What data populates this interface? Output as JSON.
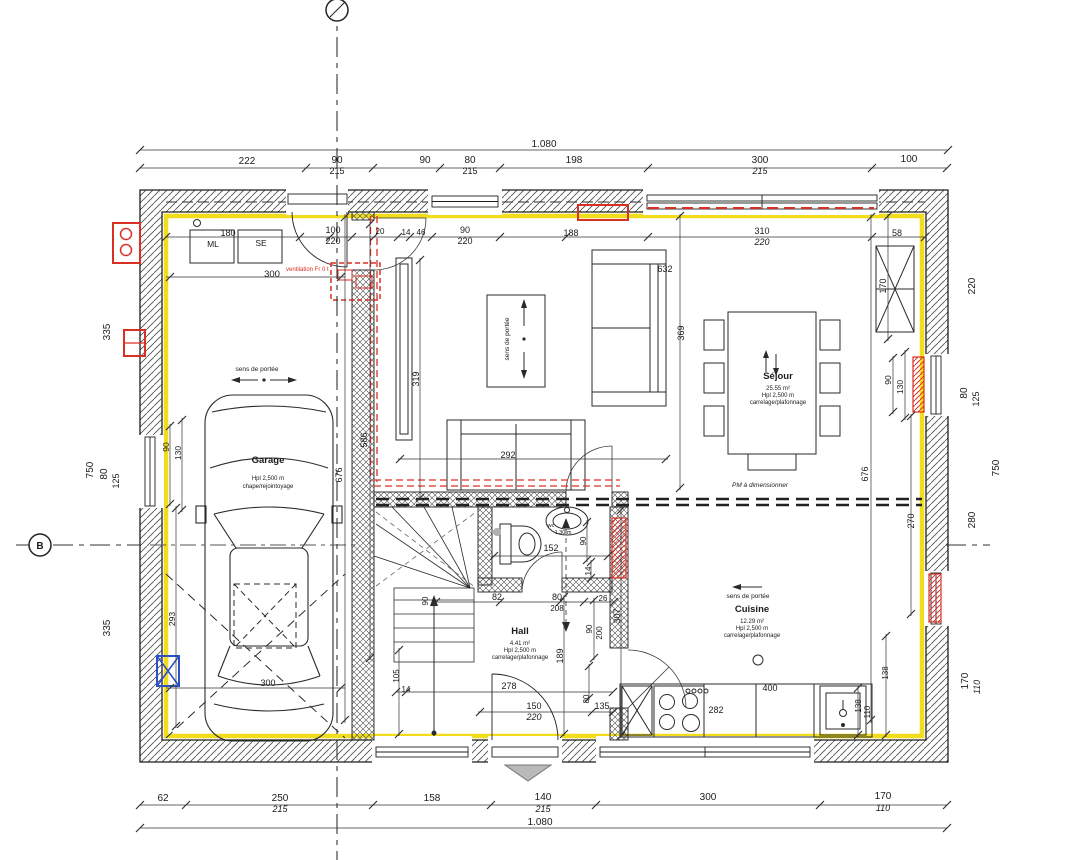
{
  "colors": {
    "paper": "#ffffff",
    "ink": "#1e1e1e",
    "insulation_yellow": "#f1dd1b",
    "annotation_red": "#d93025",
    "marker_blue": "#2b50c8",
    "step_gray": "#b9b9b9"
  },
  "rooms": [
    {
      "name": "Garage",
      "ceiling": "Hpl 2,500 m",
      "finish": "chape/rejointoyage"
    },
    {
      "name": "Séjour",
      "area": "25.55 m²",
      "ceiling": "Hpl 2,500 m",
      "finish": "carrelage/plafonnage"
    },
    {
      "name": "Cuisine",
      "area": "12.29 m²",
      "ceiling": "Hpl 2,500 m",
      "finish": "carrelage/plafonnage"
    },
    {
      "name": "Hall",
      "area": "4.41 m²",
      "ceiling": "Hpl 2,500 m",
      "finish": "carrelage/plafonnage"
    },
    {
      "name": "wc",
      "area": "1.30 m"
    }
  ],
  "annotations": {
    "span_direction": "sens de portée",
    "beam_note": "PM à dimensionner",
    "vent_note": "ventilation Fr 0 t",
    "washer": "ML",
    "dryer": "SE",
    "section_marker": "B"
  },
  "dims": {
    "top": {
      "total": "1.080",
      "d1": "222",
      "d2": "90",
      "d2s": "215",
      "d3": "90",
      "d4": "80",
      "d4s": "215",
      "d5": "198",
      "d6": "300",
      "d6s": "215",
      "d7": "100"
    },
    "bottom": {
      "total": "1.080",
      "d1": "62",
      "d2": "250",
      "d2s": "215",
      "d3": "158",
      "d4": "140",
      "d4s": "215",
      "d5": "300",
      "d6": "170",
      "d6s": "110"
    },
    "left": {
      "total": "750",
      "d1": "335",
      "d2": "80",
      "d2s": "125",
      "d3": "335"
    },
    "right": {
      "total": "750",
      "d1": "220",
      "d2": "80",
      "d2s": "125",
      "d3": "280",
      "d4": "170",
      "d4s": "110"
    },
    "inner_top": {
      "d180": "180",
      "d100": "100",
      "d100s": "220",
      "d20": "20",
      "d14": "14",
      "d46": "46",
      "d90": "90",
      "d90s": "220",
      "d188": "188",
      "d310": "310",
      "d310s": "220",
      "d58": "58",
      "d170": "170"
    },
    "garage": {
      "w300": "300",
      "w300b": "300",
      "d90": "90",
      "d130": "130",
      "d293": "293",
      "d676": "676",
      "d586": "586",
      "d319": "319"
    },
    "sejour": {
      "d632": "632",
      "d369": "369",
      "d292": "292",
      "d676": "676",
      "d90": "90",
      "d130": "130",
      "d270": "270"
    },
    "cuisine": {
      "d400": "400",
      "d282": "282",
      "d138a": "138",
      "d110": "110",
      "d138b": "138",
      "d307": "307",
      "d90": "90",
      "d200": "200",
      "d80": "80",
      "d26": "26"
    },
    "hall": {
      "d82": "82",
      "d80": "80",
      "d208": "208",
      "d152": "152",
      "d90w": "90",
      "d14w": "14",
      "d189": "189",
      "d278": "278",
      "d150": "150",
      "d150s": "220",
      "d135": "135",
      "d14b": "14",
      "d105": "105",
      "d90s": "90"
    }
  }
}
